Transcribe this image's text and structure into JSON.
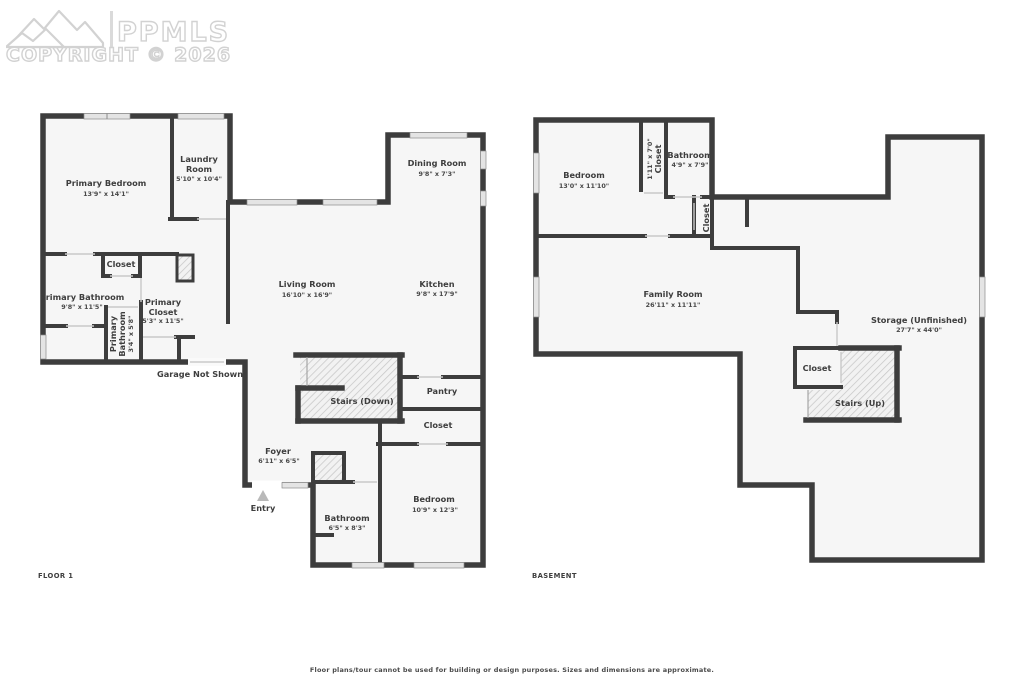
{
  "logo": {
    "brand": "PPMLS",
    "copyright": "COPYRIGHT © 2026"
  },
  "floor1": {
    "title": "FLOOR 1",
    "note": "Garage Not Shown",
    "rooms": {
      "primary_bedroom": {
        "name": "Primary Bedroom",
        "dims": "13'9\" x 14'1\""
      },
      "laundry_room": {
        "name_line1": "Laundry",
        "name_line2": "Room",
        "dims": "5'10\" x 10'4\""
      },
      "closet_top": {
        "name": "Closet"
      },
      "primary_bathroom": {
        "name": "Primary Bathroom",
        "dims": "9'8\" x 11'5\""
      },
      "primary_closet": {
        "name_line1": "Primary",
        "name_line2": "Closet",
        "dims": "5'3\" x 11'5\""
      },
      "primary_bathroom_small": {
        "name_line1": "Primary",
        "name_line2": "Bathroom",
        "dims": "3'4\" x 5'8\""
      },
      "living_room": {
        "name": "Living Room",
        "dims": "16'10\" x 16'9\""
      },
      "dining_room": {
        "name": "Dining Room",
        "dims": "9'8\" x 7'3\""
      },
      "kitchen": {
        "name": "Kitchen",
        "dims": "9'8\" x 17'9\""
      },
      "stairs_down": {
        "name": "Stairs (Down)"
      },
      "pantry": {
        "name": "Pantry"
      },
      "closet_hall": {
        "name": "Closet"
      },
      "foyer": {
        "name": "Foyer",
        "dims": "6'11\" x 6'5\""
      },
      "entry": {
        "name": "Entry"
      },
      "bathroom": {
        "name": "Bathroom",
        "dims": "6'5\" x 8'3\""
      },
      "bedroom": {
        "name": "Bedroom",
        "dims": "10'9\" x 12'3\""
      }
    }
  },
  "basement": {
    "title": "BASEMENT",
    "rooms": {
      "bedroom": {
        "name": "Bedroom",
        "dims": "13'0\" x 11'10\""
      },
      "closet_bed": {
        "name": "Closet",
        "dims": "1'11\" x 7'0\""
      },
      "bathroom": {
        "name": "Bathroom",
        "dims": "4'9\" x 7'9\""
      },
      "closet_hall": {
        "name": "Closet"
      },
      "family_room": {
        "name": "Family Room",
        "dims": "26'11\" x 11'11\""
      },
      "storage": {
        "name": "Storage (Unfinished)",
        "dims": "27'7\" x 44'0\""
      },
      "closet_stairs": {
        "name": "Closet"
      },
      "stairs_up": {
        "name": "Stairs (Up)"
      }
    }
  },
  "footer": {
    "disclaimer": "Floor plans/tour cannot be used for building or design purposes. Sizes and dimensions are approximate."
  },
  "colors": {
    "wall": "#3d3d3d",
    "room_fill": "#f6f6f6",
    "window": "#e4e4e4",
    "label": "#3e3e3e"
  }
}
